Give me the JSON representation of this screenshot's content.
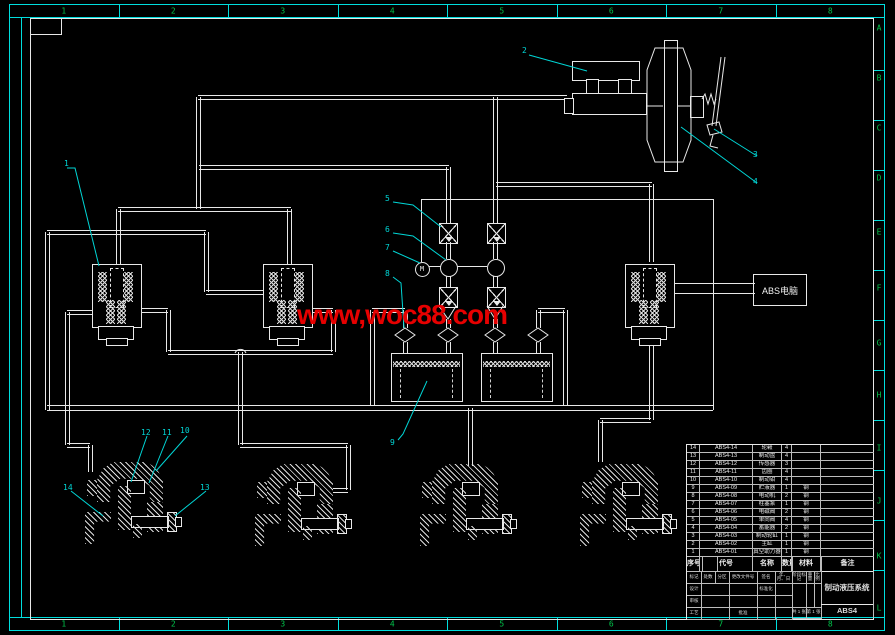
{
  "frame": {
    "top_numbers": [
      "1",
      "2",
      "3",
      "4",
      "5",
      "6",
      "7",
      "8"
    ],
    "bottom_numbers": [
      "1",
      "2",
      "3",
      "4",
      "5",
      "6",
      "7",
      "8"
    ],
    "right_letters": [
      "A",
      "B",
      "C",
      "D",
      "E",
      "F",
      "G",
      "H",
      "I",
      "J",
      "K",
      "L"
    ]
  },
  "watermark": {
    "text": "www,woc88.com",
    "color": "#e60000"
  },
  "schematic": {
    "abs_ecu_label": "ABS电脑",
    "motor_label": "M",
    "callout_numbers": [
      "1",
      "2",
      "3",
      "4",
      "5",
      "6",
      "7",
      "8",
      "9",
      "10",
      "11",
      "12",
      "13",
      "14"
    ]
  },
  "title_block": {
    "parts_header": {
      "seq": "序号",
      "code": "代号",
      "name": "名称",
      "qty": "数量",
      "material": "材料",
      "notes": "备注"
    },
    "parts": [
      {
        "seq": "14",
        "code": "ABS4-14",
        "name": "轮毂",
        "qty": "4",
        "mat": "",
        "note": ""
      },
      {
        "seq": "13",
        "code": "ABS4-13",
        "name": "制动盘",
        "qty": "4",
        "mat": "",
        "note": ""
      },
      {
        "seq": "12",
        "code": "ABS4-12",
        "name": "传感器",
        "qty": "3",
        "mat": "",
        "note": ""
      },
      {
        "seq": "11",
        "code": "ABS4-11",
        "name": "齿圈",
        "qty": "4",
        "mat": "",
        "note": ""
      },
      {
        "seq": "10",
        "code": "ABS4-10",
        "name": "制动钳",
        "qty": "4",
        "mat": "",
        "note": ""
      },
      {
        "seq": "9",
        "code": "ABS4-09",
        "name": "贮液器",
        "qty": "1",
        "mat": "钢",
        "note": ""
      },
      {
        "seq": "8",
        "code": "ABS4-08",
        "name": "电动机",
        "qty": "2",
        "mat": "钢",
        "note": ""
      },
      {
        "seq": "7",
        "code": "ABS4-07",
        "name": "柱塞泵",
        "qty": "1",
        "mat": "钢",
        "note": ""
      },
      {
        "seq": "6",
        "code": "ABS4-06",
        "name": "电磁阀",
        "qty": "2",
        "mat": "钢",
        "note": ""
      },
      {
        "seq": "5",
        "code": "ABS4-05",
        "name": "单向阀",
        "qty": "4",
        "mat": "钢",
        "note": ""
      },
      {
        "seq": "4",
        "code": "ABS4-04",
        "name": "蓄能器",
        "qty": "2",
        "mat": "钢",
        "note": ""
      },
      {
        "seq": "3",
        "code": "ABS4-03",
        "name": "制动轮缸",
        "qty": "1",
        "mat": "钢",
        "note": ""
      },
      {
        "seq": "2",
        "code": "ABS4-02",
        "name": "主缸",
        "qty": "1",
        "mat": "钢",
        "note": ""
      },
      {
        "seq": "1",
        "code": "ABS4-01",
        "name": "真空助力器",
        "qty": "1",
        "mat": "钢",
        "note": ""
      }
    ],
    "revision_header": [
      "标记",
      "处数",
      "分区",
      "更改文件号",
      "签名",
      "年、月、日"
    ],
    "sign_rows": [
      [
        "设计",
        "",
        "",
        "标准化",
        ""
      ],
      [
        "审核",
        "",
        "",
        "",
        ""
      ],
      [
        "工艺",
        "",
        "批准",
        "",
        ""
      ]
    ],
    "stage_labels": [
      "阶段标记",
      "重量",
      "比例"
    ],
    "sheet_info": [
      "共 1 张",
      "第 1 张"
    ],
    "title": "制动液压系统",
    "drawing_no": "ABS4"
  }
}
